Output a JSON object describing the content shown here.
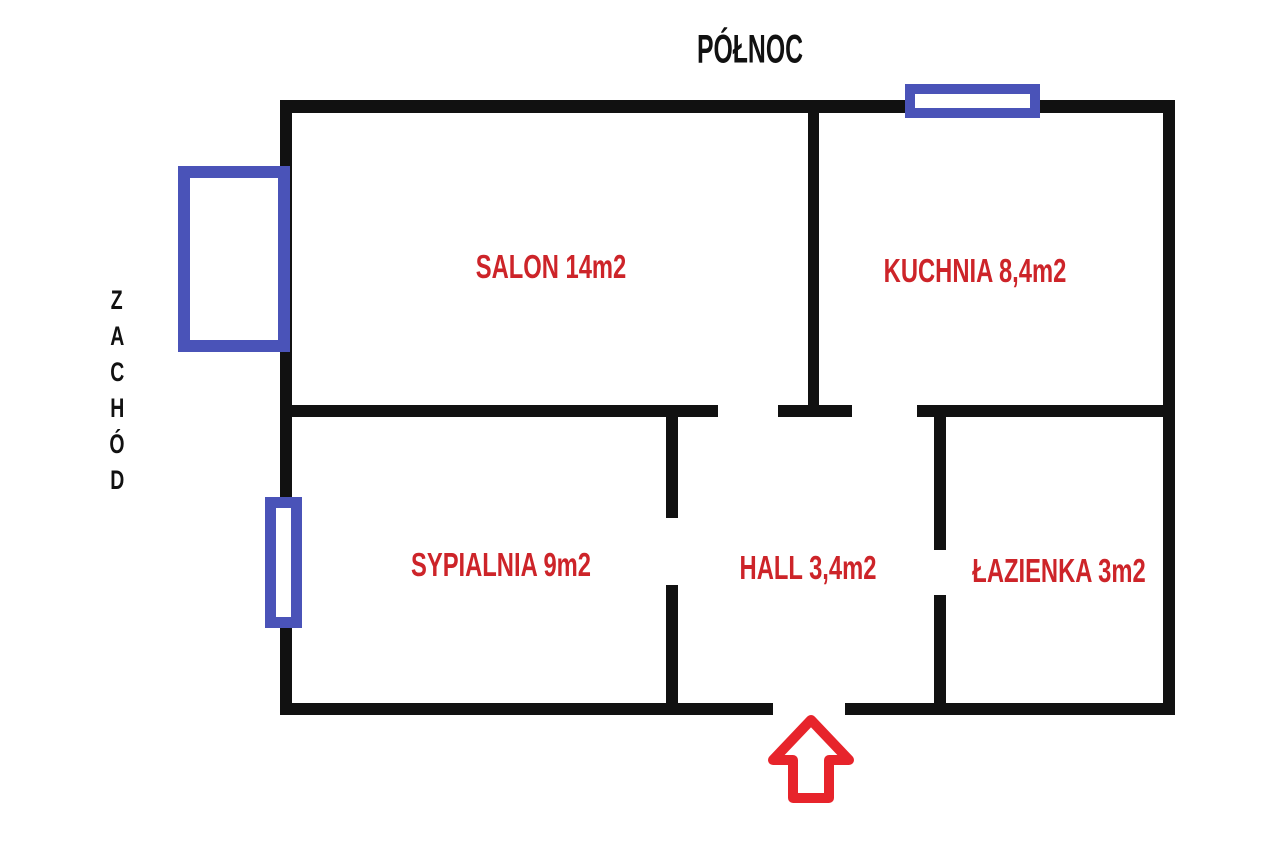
{
  "compass": {
    "north_label": "PÓŁNOC",
    "west_label": "ZACHÓD",
    "west_letters": [
      "Z",
      "A",
      "C",
      "H",
      "Ó",
      "D"
    ]
  },
  "rooms": [
    {
      "id": "salon",
      "label": "SALON 14m2"
    },
    {
      "id": "kuchnia",
      "label": "KUCHNIA 8,4m2"
    },
    {
      "id": "sypialnia",
      "label": "SYPIALNIA 9m2"
    },
    {
      "id": "hall",
      "label": "HALL 3,4m2"
    },
    {
      "id": "lazienka",
      "label": "ŁAZIENKA 3m2"
    }
  ],
  "openings": {
    "windows": [
      "window-north",
      "window-west-large",
      "window-west-small"
    ],
    "entrance_icon": "up-arrow"
  },
  "colors": {
    "wall-color": "#111111",
    "label-red": "#cd2429",
    "window-blue": "#4a53b8",
    "arrow-red": "#e7242b",
    "bg-color": "#ffffff"
  }
}
